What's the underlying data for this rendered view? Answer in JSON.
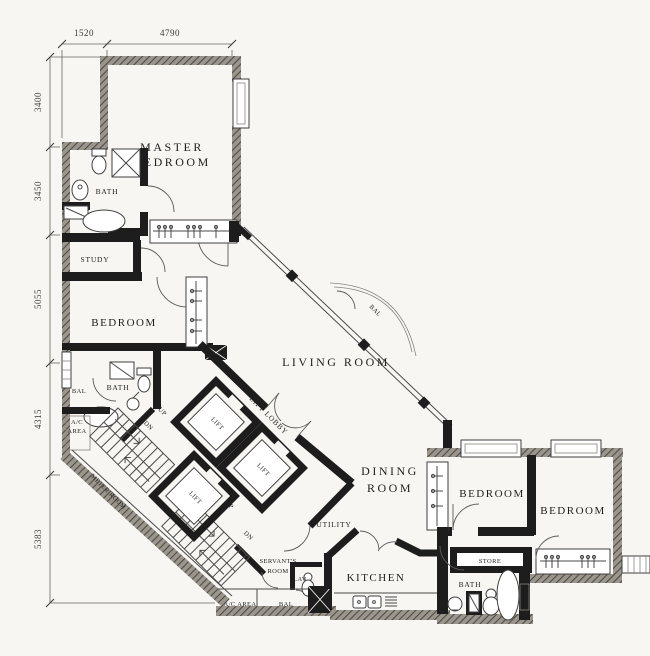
{
  "title": "apartment-floor-plan",
  "colors": {
    "background": "#f7f6f2",
    "interior_walls": "#1d1d1d",
    "exterior_walls_hatch": "#5d5952",
    "line_work": "#4a4a4a",
    "text": "#1f1f1f"
  },
  "dims": {
    "top": [
      "1520",
      "4790"
    ],
    "left": [
      "3400",
      "3450",
      "5055",
      "4315",
      "5383"
    ]
  },
  "rooms": {
    "master_bedroom": {
      "line1": "MASTER",
      "line2": "BEDROOM"
    },
    "master_bath": "BATH",
    "study": "STUDY",
    "bedroom_left": "BEDROOM",
    "bath_left": "BATH",
    "bal_left": "BAL",
    "ac_area_left": {
      "line1": "A/C",
      "line2": "AREA"
    },
    "meter_room": "METER ROOM",
    "lift_lobby": "LIFT LOBBY",
    "lift_a": "LIFT",
    "lift_b": "LIFT",
    "lift_c": "LIFT",
    "stair_dn_upper": "DN",
    "stair_up_upper": "UP",
    "stair_up_lower": "UP",
    "stair_dn_lower": "DN",
    "living_room": "LIVING ROOM",
    "balcony_living": "BAL",
    "dining_room": {
      "line1": "DINING",
      "line2": "ROOM"
    },
    "utility": "UTILITY",
    "servants_room": {
      "line1": "SERVANT'S",
      "line2": "ROOM"
    },
    "lav": "LAV",
    "ac_area_bottom": "A/C AREA",
    "bal_bottom": "BAL",
    "kitchen": "KITCHEN",
    "bedroom_mid": "BEDROOM",
    "bedroom_right": "BEDROOM",
    "store": "STORE",
    "bath_right": "BATH"
  }
}
